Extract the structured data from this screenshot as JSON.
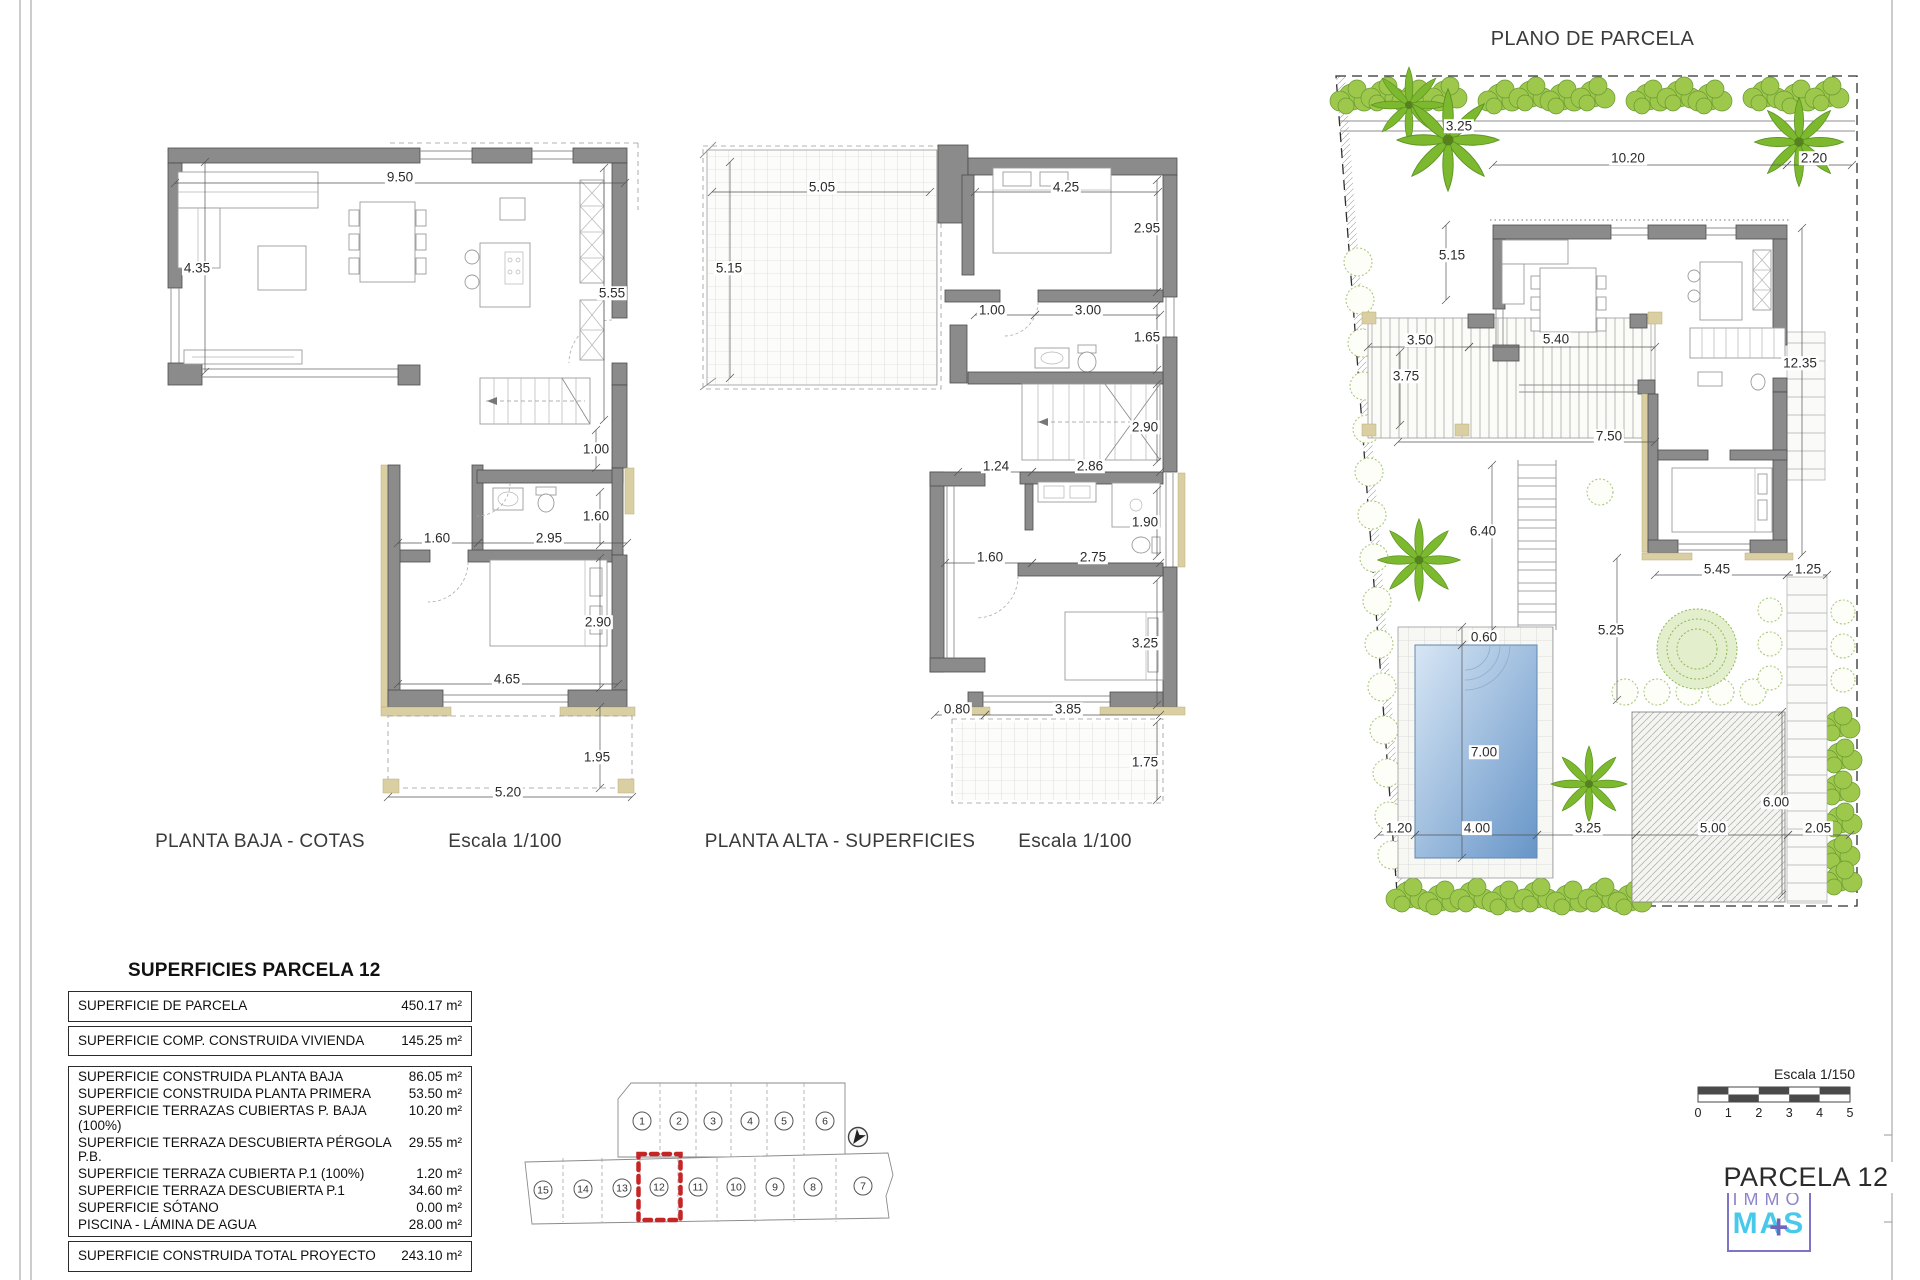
{
  "plans": {
    "planta_baja": {
      "title": "PLANTA BAJA - COTAS",
      "scale": "Escala 1/100"
    },
    "planta_alta": {
      "title": "PLANTA ALTA - SUPERFICIES",
      "scale": "Escala 1/100"
    },
    "parcela": {
      "title": "PLANO DE PARCELA"
    }
  },
  "dimensions": {
    "planta_baja": [
      {
        "t": "9.50",
        "x": 400,
        "y": 177
      },
      {
        "t": "4.35",
        "x": 197,
        "y": 268
      },
      {
        "t": "5.55",
        "x": 612,
        "y": 293
      },
      {
        "t": "1.00",
        "x": 596,
        "y": 449
      },
      {
        "t": "1.60",
        "x": 437,
        "y": 538
      },
      {
        "t": "2.95",
        "x": 549,
        "y": 538
      },
      {
        "t": "1.60",
        "x": 596,
        "y": 516
      },
      {
        "t": "2.90",
        "x": 598,
        "y": 622
      },
      {
        "t": "4.65",
        "x": 507,
        "y": 679
      },
      {
        "t": "1.95",
        "x": 597,
        "y": 757
      },
      {
        "t": "5.20",
        "x": 508,
        "y": 792
      }
    ],
    "planta_alta": [
      {
        "t": "5.05",
        "x": 822,
        "y": 187
      },
      {
        "t": "5.15",
        "x": 729,
        "y": 268
      },
      {
        "t": "4.25",
        "x": 1066,
        "y": 187
      },
      {
        "t": "2.95",
        "x": 1147,
        "y": 228
      },
      {
        "t": "1.00",
        "x": 992,
        "y": 310
      },
      {
        "t": "3.00",
        "x": 1088,
        "y": 310
      },
      {
        "t": "1.65",
        "x": 1147,
        "y": 337
      },
      {
        "t": "2.90",
        "x": 1145,
        "y": 427
      },
      {
        "t": "1.24",
        "x": 996,
        "y": 466
      },
      {
        "t": "2.86",
        "x": 1090,
        "y": 466
      },
      {
        "t": "1.90",
        "x": 1145,
        "y": 522
      },
      {
        "t": "1.60",
        "x": 990,
        "y": 557
      },
      {
        "t": "2.75",
        "x": 1093,
        "y": 557
      },
      {
        "t": "3.25",
        "x": 1145,
        "y": 643
      },
      {
        "t": "0.80",
        "x": 957,
        "y": 709
      },
      {
        "t": "3.85",
        "x": 1068,
        "y": 709
      },
      {
        "t": "1.75",
        "x": 1145,
        "y": 762
      }
    ],
    "parcela": [
      {
        "t": "3.25",
        "x": 1459,
        "y": 126
      },
      {
        "t": "10.20",
        "x": 1628,
        "y": 158
      },
      {
        "t": "2.20",
        "x": 1814,
        "y": 158
      },
      {
        "t": "5.15",
        "x": 1452,
        "y": 255
      },
      {
        "t": "3.50",
        "x": 1420,
        "y": 340
      },
      {
        "t": "5.40",
        "x": 1556,
        "y": 339
      },
      {
        "t": "3.75",
        "x": 1406,
        "y": 376
      },
      {
        "t": "7.50",
        "x": 1609,
        "y": 436
      },
      {
        "t": "12.35",
        "x": 1800,
        "y": 363
      },
      {
        "t": "6.40",
        "x": 1483,
        "y": 531
      },
      {
        "t": "5.45",
        "x": 1717,
        "y": 569
      },
      {
        "t": "1.25",
        "x": 1808,
        "y": 569
      },
      {
        "t": "5.25",
        "x": 1611,
        "y": 630
      },
      {
        "t": "0.60",
        "x": 1484,
        "y": 637
      },
      {
        "t": "7.00",
        "x": 1484,
        "y": 752
      },
      {
        "t": "1.20",
        "x": 1399,
        "y": 828
      },
      {
        "t": "4.00",
        "x": 1477,
        "y": 828
      },
      {
        "t": "3.25",
        "x": 1588,
        "y": 828
      },
      {
        "t": "5.00",
        "x": 1713,
        "y": 828
      },
      {
        "t": "6.00",
        "x": 1776,
        "y": 802
      },
      {
        "t": "2.05",
        "x": 1818,
        "y": 828
      }
    ]
  },
  "dim_lines": [
    [
      175,
      183,
      625,
      183
    ],
    [
      205,
      162,
      205,
      372
    ],
    [
      604,
      168,
      604,
      420
    ],
    [
      596,
      430,
      596,
      468
    ],
    [
      398,
      543,
      478,
      543
    ],
    [
      478,
      543,
      627,
      543
    ],
    [
      600,
      492,
      600,
      545
    ],
    [
      600,
      558,
      600,
      688
    ],
    [
      398,
      684,
      618,
      684
    ],
    [
      600,
      707,
      600,
      788
    ],
    [
      388,
      797,
      632,
      797
    ],
    [
      712,
      192,
      930,
      192
    ],
    [
      730,
      162,
      730,
      378
    ],
    [
      975,
      192,
      1158,
      192
    ],
    [
      1157,
      180,
      1157,
      292
    ],
    [
      975,
      315,
      1035,
      315
    ],
    [
      1035,
      315,
      1160,
      315
    ],
    [
      1157,
      305,
      1157,
      370
    ],
    [
      1157,
      384,
      1157,
      462
    ],
    [
      958,
      472,
      1032,
      472
    ],
    [
      1032,
      472,
      1160,
      472
    ],
    [
      1157,
      490,
      1157,
      556
    ],
    [
      945,
      563,
      1032,
      563
    ],
    [
      1032,
      563,
      1160,
      563
    ],
    [
      1157,
      580,
      1157,
      705
    ],
    [
      935,
      715,
      985,
      715
    ],
    [
      985,
      715,
      1160,
      715
    ],
    [
      1157,
      722,
      1157,
      800
    ],
    [
      1493,
      165,
      1787,
      165
    ],
    [
      1787,
      165,
      1852,
      165
    ],
    [
      1446,
      225,
      1446,
      300
    ],
    [
      1368,
      347,
      1469,
      347
    ],
    [
      1469,
      347,
      1655,
      347
    ],
    [
      1400,
      352,
      1400,
      425
    ],
    [
      1398,
      442,
      1655,
      442
    ],
    [
      1802,
      228,
      1802,
      555
    ],
    [
      1492,
      465,
      1492,
      630
    ],
    [
      1655,
      575,
      1787,
      575
    ],
    [
      1787,
      575,
      1827,
      575
    ],
    [
      1617,
      558,
      1617,
      700
    ],
    [
      1462,
      627,
      1462,
      645
    ],
    [
      1462,
      645,
      1462,
      858
    ],
    [
      1378,
      835,
      1415,
      835
    ],
    [
      1415,
      835,
      1537,
      835
    ],
    [
      1537,
      835,
      1636,
      835
    ],
    [
      1636,
      835,
      1788,
      835
    ],
    [
      1788,
      835,
      1850,
      835
    ],
    [
      1782,
      712,
      1782,
      895
    ]
  ],
  "areas_table": {
    "title": "SUPERFICIES PARCELA 12",
    "groups": [
      [
        {
          "label": "SUPERFICIE DE PARCELA",
          "value": "450.17 m²"
        }
      ],
      [
        {
          "label": "SUPERFICIE COMP. CONSTRUIDA VIVIENDA",
          "value": "145.25 m²"
        }
      ],
      [
        {
          "label": "SUPERFICIE CONSTRUIDA PLANTA BAJA",
          "value": "86.05 m²"
        },
        {
          "label": "SUPERFICIE CONSTRUIDA PLANTA PRIMERA",
          "value": "53.50 m²"
        },
        {
          "label": "SUPERFICIE TERRAZAS CUBIERTAS P. BAJA (100%)",
          "value": "10.20 m²"
        },
        {
          "label": "SUPERFICIE TERRAZA DESCUBIERTA PÉRGOLA P.B.",
          "value": "29.55 m²"
        },
        {
          "label": "SUPERFICIE TERRAZA CUBIERTA P.1 (100%)",
          "value": "1.20 m²"
        },
        {
          "label": "SUPERFICIE TERRAZA DESCUBIERTA P.1",
          "value": "34.60 m²"
        },
        {
          "label": "SUPERFICIE SÓTANO",
          "value": "0.00 m²"
        },
        {
          "label": "PISCINA - LÁMINA DE AGUA",
          "value": "28.00 m²"
        }
      ],
      [
        {
          "label": "SUPERFICIE CONSTRUIDA TOTAL PROYECTO",
          "value": "243.10 m²"
        }
      ]
    ]
  },
  "plot_map": {
    "plots_top": [
      {
        "n": "1",
        "x": 642,
        "y": 1121
      },
      {
        "n": "2",
        "x": 679,
        "y": 1121
      },
      {
        "n": "3",
        "x": 713,
        "y": 1121
      },
      {
        "n": "4",
        "x": 750,
        "y": 1121
      },
      {
        "n": "5",
        "x": 784,
        "y": 1121
      },
      {
        "n": "6",
        "x": 825,
        "y": 1121
      }
    ],
    "plots_bottom": [
      {
        "n": "15",
        "x": 543,
        "y": 1190
      },
      {
        "n": "14",
        "x": 583,
        "y": 1189
      },
      {
        "n": "13",
        "x": 622,
        "y": 1188
      },
      {
        "n": "12",
        "x": 659,
        "y": 1187
      },
      {
        "n": "11",
        "x": 698,
        "y": 1187
      },
      {
        "n": "10",
        "x": 736,
        "y": 1187
      },
      {
        "n": "9",
        "x": 775,
        "y": 1187
      },
      {
        "n": "8",
        "x": 813,
        "y": 1187
      },
      {
        "n": "7",
        "x": 863,
        "y": 1186
      }
    ],
    "highlighted_plot": "12",
    "highlight_color": "#c52525"
  },
  "title_block": {
    "scale_label": "Escala 1/150",
    "ticks": [
      "0",
      "1",
      "2",
      "3",
      "4",
      "5"
    ],
    "parcel_title": "PARCELA 12",
    "logo_line1": "IMMO",
    "logo_line2": "MAS",
    "logo_plus": "+",
    "logo_purple": "#7d74c4",
    "logo_cyan": "#49c9e9"
  }
}
